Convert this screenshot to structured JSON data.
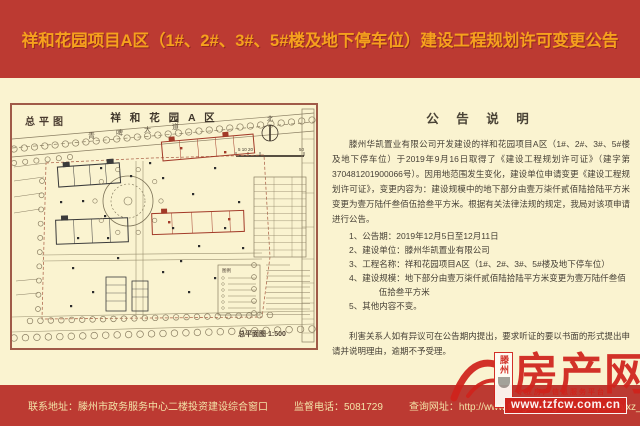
{
  "header": {
    "title": "祥和花园项目A区（1#、2#、3#、5#楼及地下停车位）建设工程规划许可变更公告"
  },
  "map": {
    "corner_label": "总平图",
    "title": "祥 和 花 园 A 区",
    "road_chars": [
      "青",
      "啤",
      "大",
      "道"
    ],
    "north_label": "北",
    "scale_ticks": "5 10  20",
    "scale_end": "50",
    "legend_title": "图例",
    "caption": "总平面图 1:500"
  },
  "notice": {
    "title": "公 告 说 明",
    "paragraph": "滕州华凯置业有限公司开发建设的祥和花园项目A区（1#、2#、3#、5#楼及地下停车位）于2019年9月16日取得了《建设工程规划许可证》（建字第370481201900066号）。因用地范围发生变化，建设单位申请变更《建设工程规划许可证》，变更内容为：建设规模中的地下部分由壹万柒仟贰佰陆拾陆平方米变更为壹万陆仟叁佰伍拾叁平方米。根据有关法律法规的规定，我局对该项申请进行公告。",
    "items": [
      "1、公告期：2019年12月5日至12月11日",
      "2、建设单位：滕州华凯置业有限公司",
      "3、工程名称：祥和花园项目A区（1#、2#、3#、5#楼及地下停车位）",
      "4、建设规模：地下部分由壹万柒仟贰佰陆拾陆平方米变更为壹万陆仟叁佰伍拾叁平方米",
      "5、其他内容不变。"
    ],
    "closing": "利害关系人如有异议可在公告期内提出，要求听证的要以书面的形式提出申请并说明理由，逾期不予受理。"
  },
  "footer": {
    "address": "联系地址：滕州市政务服务中心二楼投资建设综合窗口",
    "phone": "监督电话：5081729",
    "website": "查询网址：http://www.tengzhou.gov.cn/zzq/zfbm/xz_pfw/"
  },
  "watermark": {
    "city": "滕州",
    "brand": "房产网",
    "tagline": "专业房产信息服务平台",
    "url": "www.tzfcw.com.cn"
  },
  "colors": {
    "banner_red": "#bc3a32",
    "title_orange": "#f6a11d",
    "paper_cream": "#faf3d0",
    "map_frame": "#a05a48",
    "building_red": "#a23a28",
    "watermark_red": "#d0231c"
  }
}
